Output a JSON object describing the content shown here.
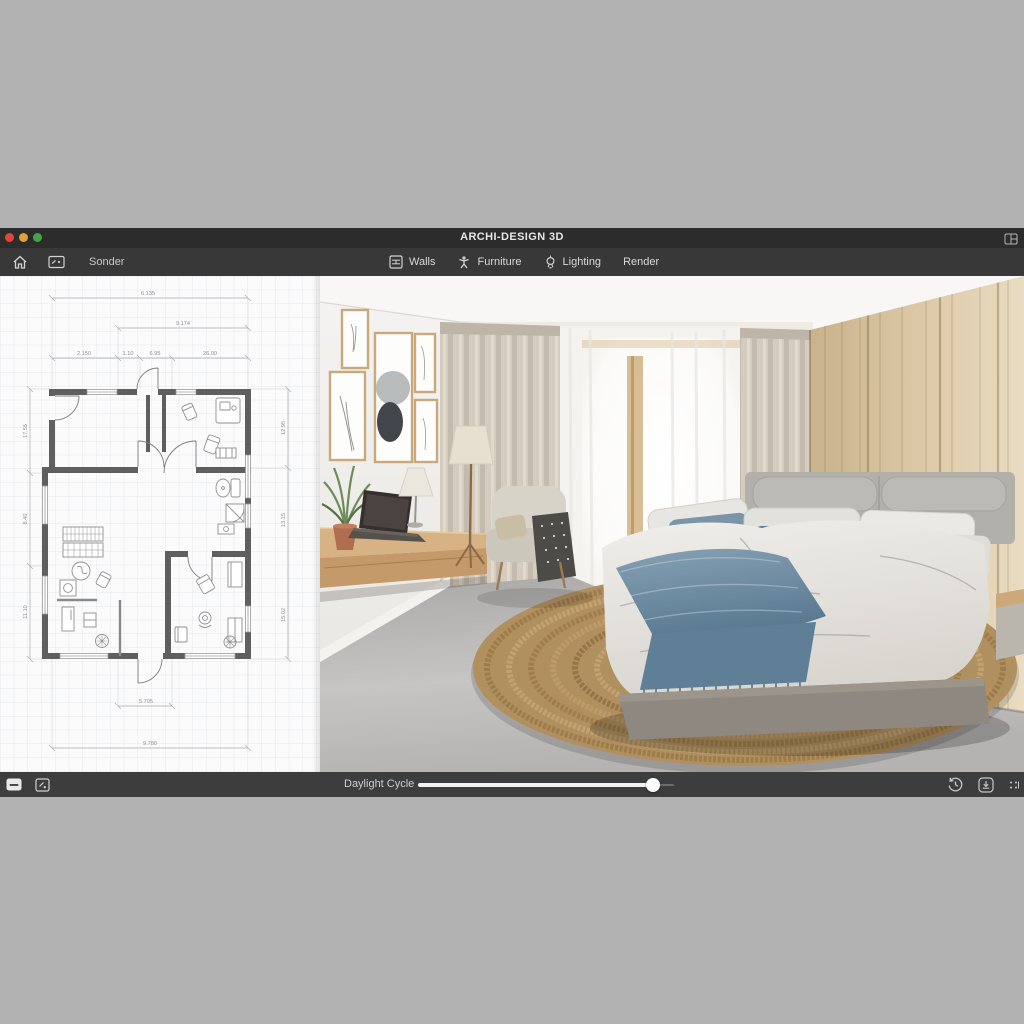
{
  "window": {
    "title": "ARCHI-DESIGN 3D",
    "traffic_lights": {
      "close": "#e0453c",
      "minimize": "#dfa136",
      "zoom": "#43a447"
    }
  },
  "toolbar": {
    "project": "Sonder",
    "menu": [
      {
        "label": "Walls",
        "icon": "walls-icon"
      },
      {
        "label": "Furniture",
        "icon": "furniture-icon"
      },
      {
        "label": "Lighting",
        "icon": "lighting-icon"
      },
      {
        "label": "Render",
        "icon": null
      }
    ]
  },
  "statusbar": {
    "daylight_label": "Daylight Cycle",
    "daylight_value_pct": 92,
    "left_icons": [
      "panel-icon",
      "snapshot-icon"
    ],
    "right_icons": [
      "history-icon",
      "download-icon",
      "resize-grip-icon"
    ]
  },
  "floor_plan": {
    "dims": {
      "top1": "6.135",
      "top2": "9.174",
      "top3a": "2.150",
      "top3b": "1.10",
      "top3c": "6.95",
      "top3d": "26.00",
      "left1": "17.55",
      "left2": "8.40",
      "left3": "11.10",
      "right1": "12.95",
      "right2": "13.15",
      "right3": "15.02",
      "bottom1": "5.705",
      "bottom2": "9.780"
    }
  },
  "colors": {
    "chrome_dark": "#2c2c2c",
    "toolbar": "#383838",
    "statusbar": "#3d3d3d",
    "desktop": "#b2b2b2",
    "plan_bg": "#fbfbfc",
    "plan_wall": "#5f5f5f",
    "wood_wall": "#d8c2a0",
    "curtain": "#d3ccbf",
    "rug": "#b1905f",
    "throw_blue": "#5f7f96",
    "pillow_blue": "#567691",
    "headboard": "#b2b0ab"
  }
}
